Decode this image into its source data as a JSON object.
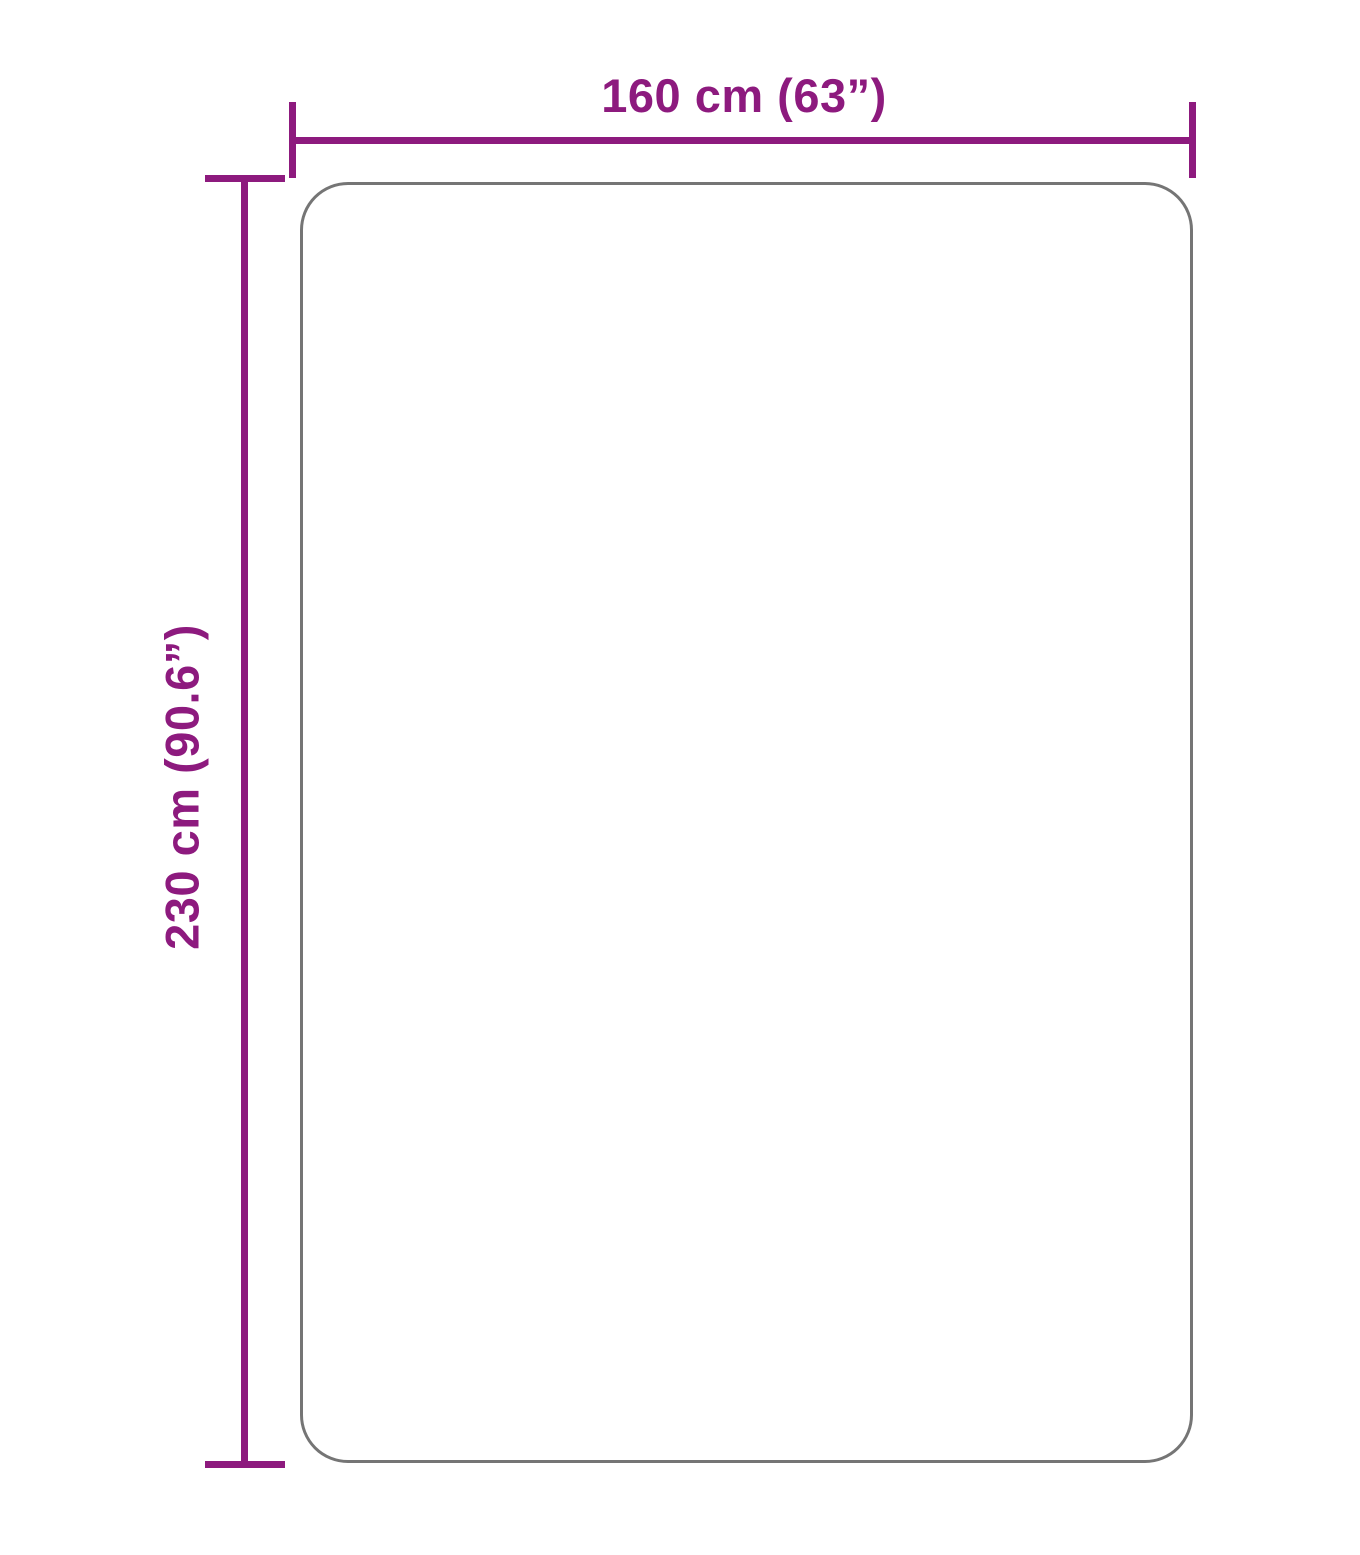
{
  "diagram": {
    "type": "product-dimension-diagram",
    "product_shape": "rounded-rectangle",
    "width_label": "160 cm (63”)",
    "height_label": "230 cm (90.6”)",
    "dimensions": {
      "width_cm": 160,
      "width_inches": 63,
      "height_cm": 230,
      "height_inches": 90.6
    },
    "colors": {
      "dimension": "#8d1a7e",
      "outline": "#757575",
      "background": "#ffffff"
    }
  }
}
